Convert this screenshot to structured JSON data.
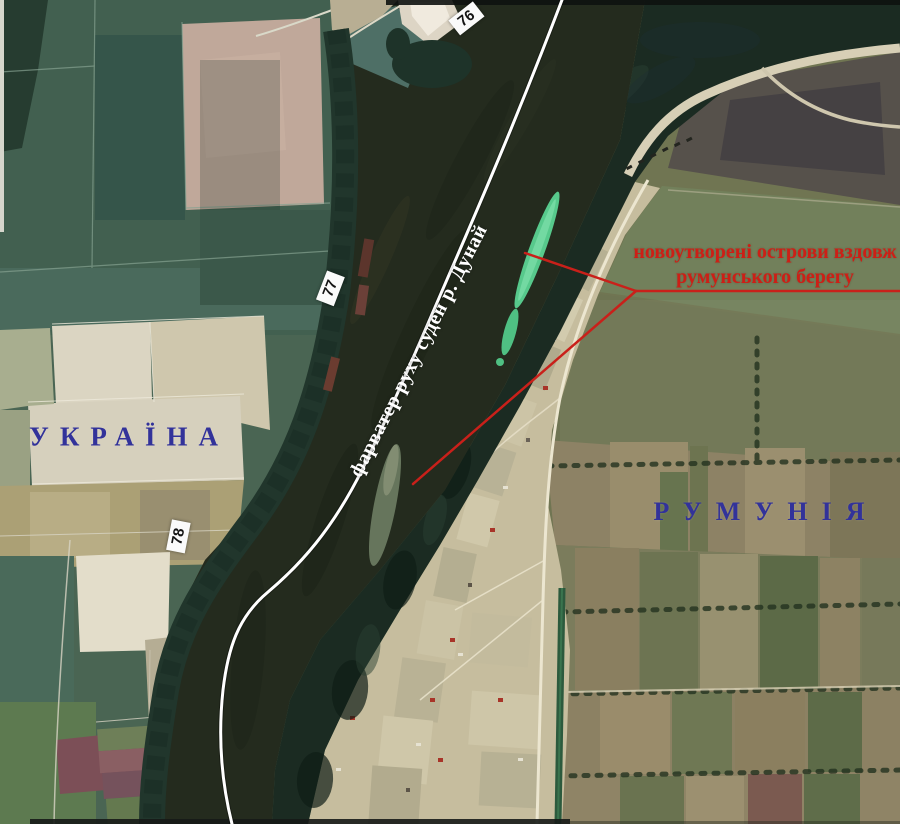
{
  "map": {
    "title": "Супутниковий знімок ділянки р. Дунай (українсько-румунський кордон)",
    "country_left": "УКРАЇНА",
    "country_right": "РУМУНІЯ",
    "fairway_label": "фарватер руху суден р. Дунай",
    "islands_note": {
      "line1": "новоутворені острови вздовж",
      "line2": "румунського берегу"
    },
    "km_markers": [
      {
        "label": "76"
      },
      {
        "label": "77"
      },
      {
        "label": "78"
      }
    ],
    "colors": {
      "country_label": "#32329a",
      "islands_note": "#cd1f16",
      "pointer_line": "#c9201a",
      "fairway_line": "#ffffff",
      "km_marker_bg": "#fafafa",
      "km_marker_text": "#141414"
    }
  }
}
